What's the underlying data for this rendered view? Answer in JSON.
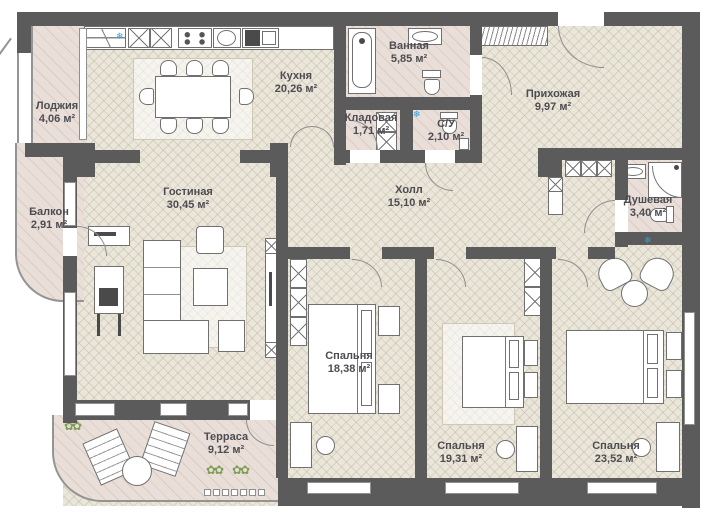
{
  "plan_type": "apartment-floor-plan",
  "rooms": {
    "loggia": {
      "name": "Лоджия",
      "area": "4,06 м²"
    },
    "balcony": {
      "name": "Балкон",
      "area": "2,91 м²"
    },
    "kitchen": {
      "name": "Кухня",
      "area": "20,26 м²"
    },
    "living": {
      "name": "Гостиная",
      "area": "30,45 м²"
    },
    "bathroom": {
      "name": "Ванная",
      "area": "5,85 м²"
    },
    "storage": {
      "name": "Кладовая",
      "area": "1,71 м²"
    },
    "wc": {
      "name": "С/У",
      "area": "2,10 м²"
    },
    "entry": {
      "name": "Прихожая",
      "area": "9,97 м²"
    },
    "hall": {
      "name": "Холл",
      "area": "15,10 м²"
    },
    "shower": {
      "name": "Душевая",
      "area": "3,40 м²"
    },
    "terrace": {
      "name": "Терраса",
      "area": "9,12 м²"
    },
    "bedroom1": {
      "name": "Спальня",
      "area": "18,38 м²"
    },
    "bedroom2": {
      "name": "Спальня",
      "area": "19,31 м²"
    },
    "bedroom3": {
      "name": "Спальня",
      "area": "23,52 м²"
    }
  },
  "glyphs": {
    "vent": "❄",
    "plant": "✿✿"
  },
  "colors": {
    "wall": "#5b5b5b",
    "wood_floor": "#ebe6da",
    "tile_floor": "#e9dfd8",
    "vent_blue": "#2e9fe0",
    "label_text": "#4c4c52"
  }
}
